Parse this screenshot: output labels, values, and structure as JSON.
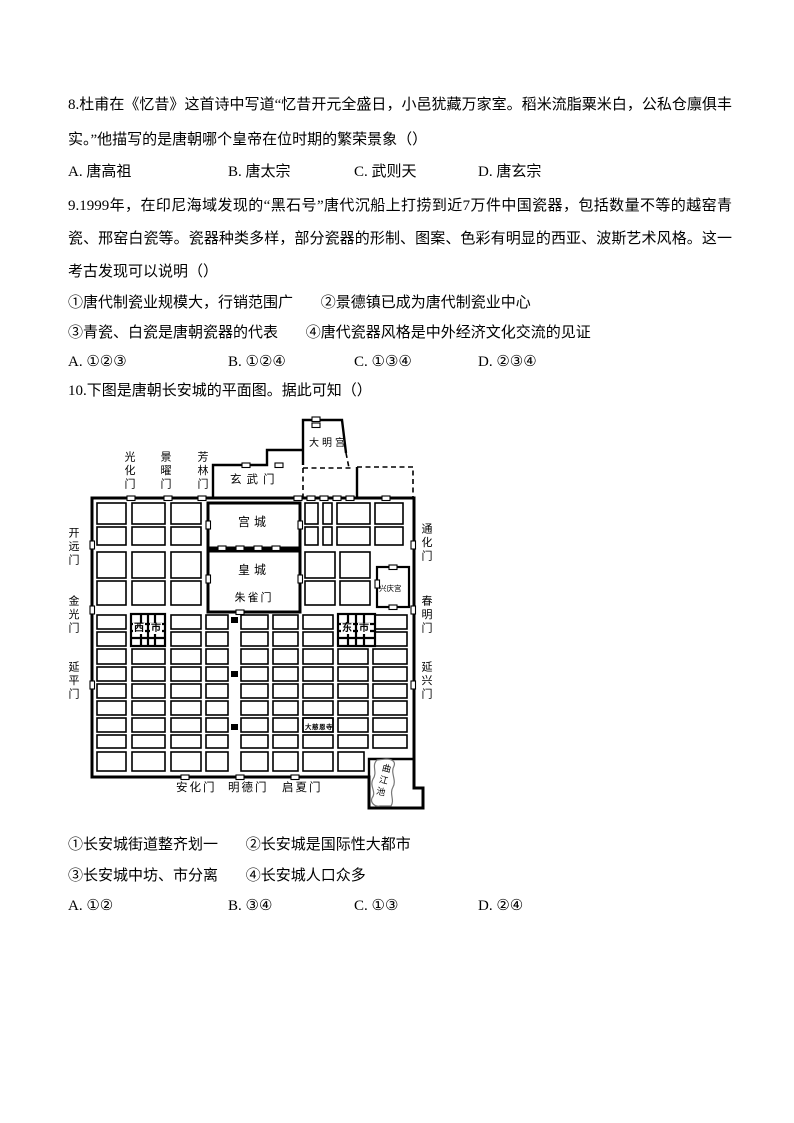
{
  "q8": {
    "text": "8.杜甫在《忆昔》这首诗中写道“忆昔开元全盛日，小邑犹藏万家室。稻米流脂粟米白，公私仓廪俱丰实。”他描写的是唐朝哪个皇帝在位时期的繁荣景象（）",
    "options": [
      "A. 唐高祖",
      "B. 唐太宗",
      "C. 武则天",
      "D. 唐玄宗"
    ]
  },
  "q9": {
    "text": "9.1999年，在印尼海域发现的“黑石号”唐代沉船上打捞到近7万件中国瓷器，包括数量不等的越窑青瓷、邢窑白瓷等。瓷器种类多样，部分瓷器的形制、图案、色彩有明显的西亚、波斯艺术风格。这一考古发现可以说明（）",
    "statement_rows": [
      [
        "①唐代制瓷业规模大，行销范围广",
        "②景德镇已成为唐代制瓷业中心"
      ],
      [
        "③青瓷、白瓷是唐朝瓷器的代表",
        "④唐代瓷器风格是中外经济文化交流的见证"
      ]
    ],
    "options": [
      "A. ①②③",
      "B. ①②④",
      "C. ①③④",
      "D. ②③④"
    ]
  },
  "q10": {
    "text": "10.下图是唐朝长安城的平面图。据此可知（）",
    "statement_rows": [
      [
        "①长安城街道整齐划一",
        "②长安城是国际性大都市"
      ],
      [
        "③长安城中坊、市分离",
        "④长安城人口众多"
      ]
    ],
    "options": [
      "A. ①②",
      "B. ③④",
      "C. ①③",
      "D. ②④"
    ]
  },
  "map": {
    "daminggong": "大明宫",
    "xuanwumen": "玄武门",
    "guanghuamen": "光化门",
    "jingyaomen": "景曜门",
    "fanglinmen": "芳林门",
    "kaiyuanmen": "开远门",
    "jinguangmen": "金光门",
    "yanpingmen": "延平门",
    "tonghuamen": "通化门",
    "chunmingmen": "春明门",
    "yanxingmen": "延兴门",
    "gongcheng": "宫城",
    "huangcheng": "皇城",
    "zhuquemen": "朱雀门",
    "xingqinggong": "兴庆宫",
    "xishi": [
      "西",
      "市"
    ],
    "dongshi": [
      "东",
      "市"
    ],
    "daciensi": "大慈恩寺",
    "qujiangchi": "曲江池",
    "anhuamen": "安化门",
    "mingdemen": "明德门",
    "qixiamen": "启夏门"
  }
}
